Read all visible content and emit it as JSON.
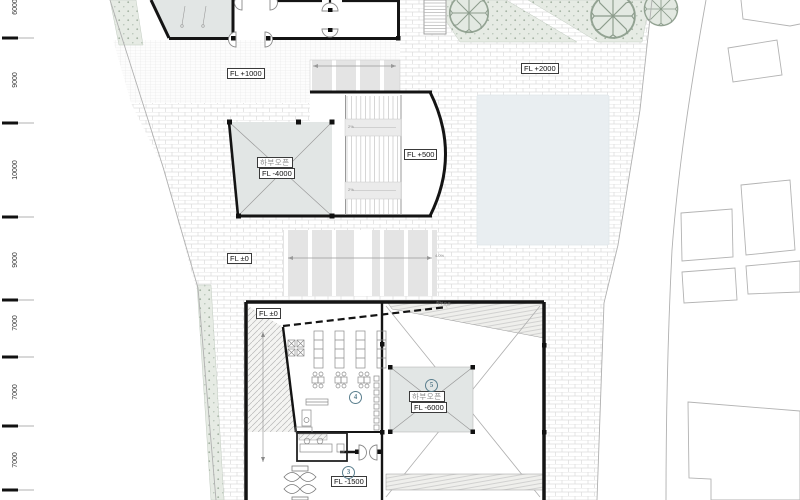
{
  "drawing": {
    "dimensions_left": [
      "6000",
      "9000",
      "10000",
      "9000",
      "7000",
      "7000",
      "7000"
    ],
    "level_labels": {
      "fl_plus_1000": "FL +1000",
      "fl_plus_2000": "FL +2000",
      "fl_plus_500": "FL +500",
      "fl_zero_upper": "FL ±0",
      "fl_zero_lower": "FL ±0",
      "fl_minus_1500": "FL -1500"
    },
    "open_below_mid": {
      "korean": "하부오픈",
      "level": "FL -4000"
    },
    "open_below_low": {
      "korean": "하부오픈",
      "level": "FL -6000"
    },
    "circled_numbers": {
      "three": "3",
      "four": "4",
      "five": "5"
    },
    "annotations": {
      "stair_note_1": "2%",
      "stair_note_2": "2%",
      "slope_label": "4.0%",
      "ramp_small_label": "하부오픈"
    },
    "colors": {
      "wall": "#141414",
      "gray_room": "#e2e6e5",
      "pond": "#e9eef1",
      "planting_green": "#e6ebe4",
      "accent_number": "#5b7f8e"
    }
  }
}
